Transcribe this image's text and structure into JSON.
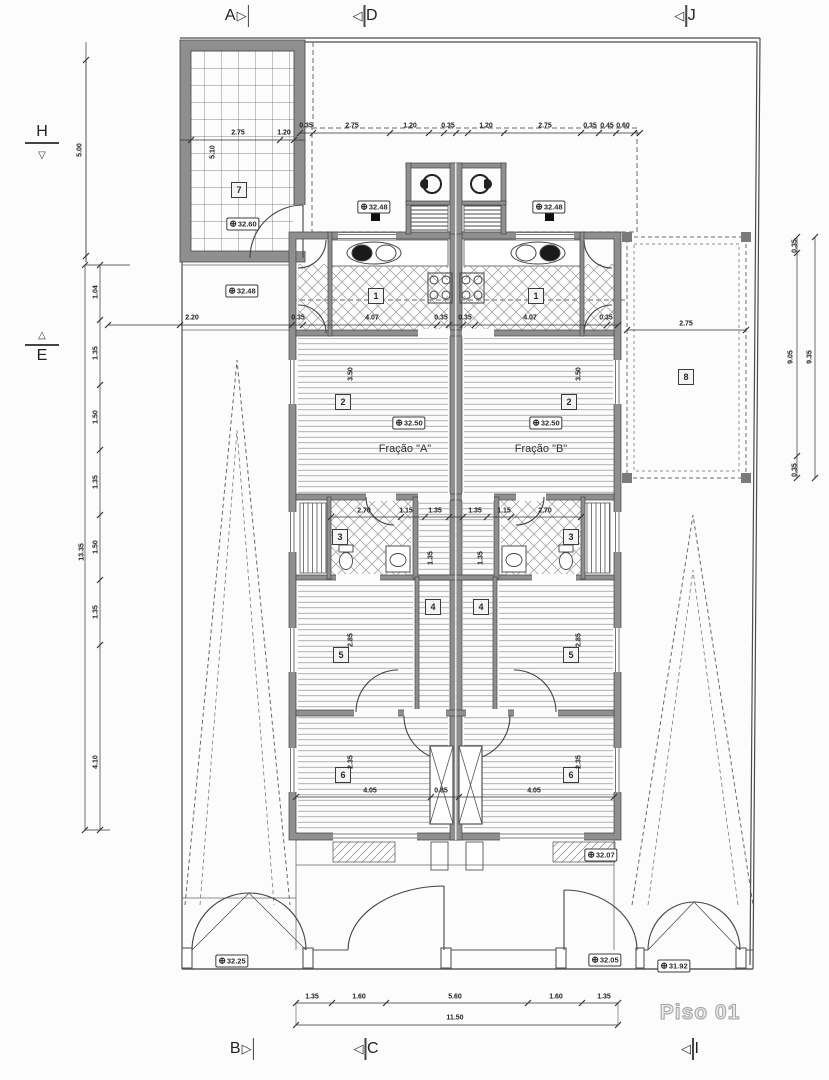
{
  "title": {
    "text": "Piso 01"
  },
  "colors": {
    "wall": "#8f8f8f",
    "line": "#3a3a3a",
    "hatch": "#888888",
    "bg": "#fcfcfc"
  },
  "icons": {
    "arrow_right": "▷",
    "arrow_left": "◁",
    "arrow_up": "△",
    "arrow_down": "▽",
    "level": "⊕"
  },
  "section_markers": [
    {
      "label": "A"
    },
    {
      "label": "D"
    },
    {
      "label": "J"
    },
    {
      "label": "B"
    },
    {
      "label": "C"
    },
    {
      "label": "I"
    },
    {
      "label": "H"
    },
    {
      "label": "E"
    }
  ],
  "units": [
    {
      "label": "Fração \"A\""
    },
    {
      "label": "Fração \"B\""
    }
  ],
  "rooms": [
    {
      "number": "7"
    },
    {
      "number": "1"
    },
    {
      "number": "1"
    },
    {
      "number": "2"
    },
    {
      "number": "2"
    },
    {
      "number": "3"
    },
    {
      "number": "3"
    },
    {
      "number": "4"
    },
    {
      "number": "4"
    },
    {
      "number": "5"
    },
    {
      "number": "5"
    },
    {
      "number": "6"
    },
    {
      "number": "6"
    },
    {
      "number": "8"
    }
  ],
  "levels": [
    {
      "value": "32.60"
    },
    {
      "value": "32.48"
    },
    {
      "value": "32.48"
    },
    {
      "value": "32.48"
    },
    {
      "value": "32.50"
    },
    {
      "value": "32.50"
    },
    {
      "value": "32.07"
    },
    {
      "value": "32.25"
    },
    {
      "value": "32.05"
    },
    {
      "value": "31.92"
    }
  ],
  "dims": [
    {
      "text": "0.35"
    },
    {
      "text": "2.75"
    },
    {
      "text": "1.20"
    },
    {
      "text": "0.35"
    },
    {
      "text": "1.20"
    },
    {
      "text": "2.75"
    },
    {
      "text": "0.35"
    },
    {
      "text": "0.45"
    },
    {
      "text": "0.60"
    },
    {
      "text": "2.75"
    },
    {
      "text": "1.20"
    },
    {
      "text": "5.10"
    },
    {
      "text": "5.00"
    },
    {
      "text": "2.20"
    },
    {
      "text": "0.35"
    },
    {
      "text": "4.07"
    },
    {
      "text": "0.35"
    },
    {
      "text": "0.35"
    },
    {
      "text": "4.07"
    },
    {
      "text": "0.35"
    },
    {
      "text": "2.75"
    },
    {
      "text": "2.70"
    },
    {
      "text": "1.15"
    },
    {
      "text": "1.35"
    },
    {
      "text": "1.35"
    },
    {
      "text": "1.15"
    },
    {
      "text": "2.70"
    },
    {
      "text": "4.05"
    },
    {
      "text": "0.85"
    },
    {
      "text": "4.05"
    },
    {
      "text": "1.35"
    },
    {
      "text": "1.60"
    },
    {
      "text": "5.60"
    },
    {
      "text": "1.60"
    },
    {
      "text": "1.35"
    },
    {
      "text": "11.50"
    },
    {
      "text": "0.35"
    },
    {
      "text": "9.05"
    },
    {
      "text": "9.35"
    },
    {
      "text": "0.35"
    },
    {
      "text": "1.04"
    },
    {
      "text": "1.35"
    },
    {
      "text": "1.50"
    },
    {
      "text": "1.35"
    },
    {
      "text": "1.50"
    },
    {
      "text": "1.35"
    },
    {
      "text": "4.10"
    },
    {
      "text": "13.35"
    },
    {
      "text": "1.35"
    },
    {
      "text": "1.35"
    },
    {
      "text": "2.85"
    },
    {
      "text": "2.85"
    },
    {
      "text": "3.50"
    },
    {
      "text": "3.50"
    },
    {
      "text": "2.35"
    },
    {
      "text": "2.35"
    }
  ]
}
